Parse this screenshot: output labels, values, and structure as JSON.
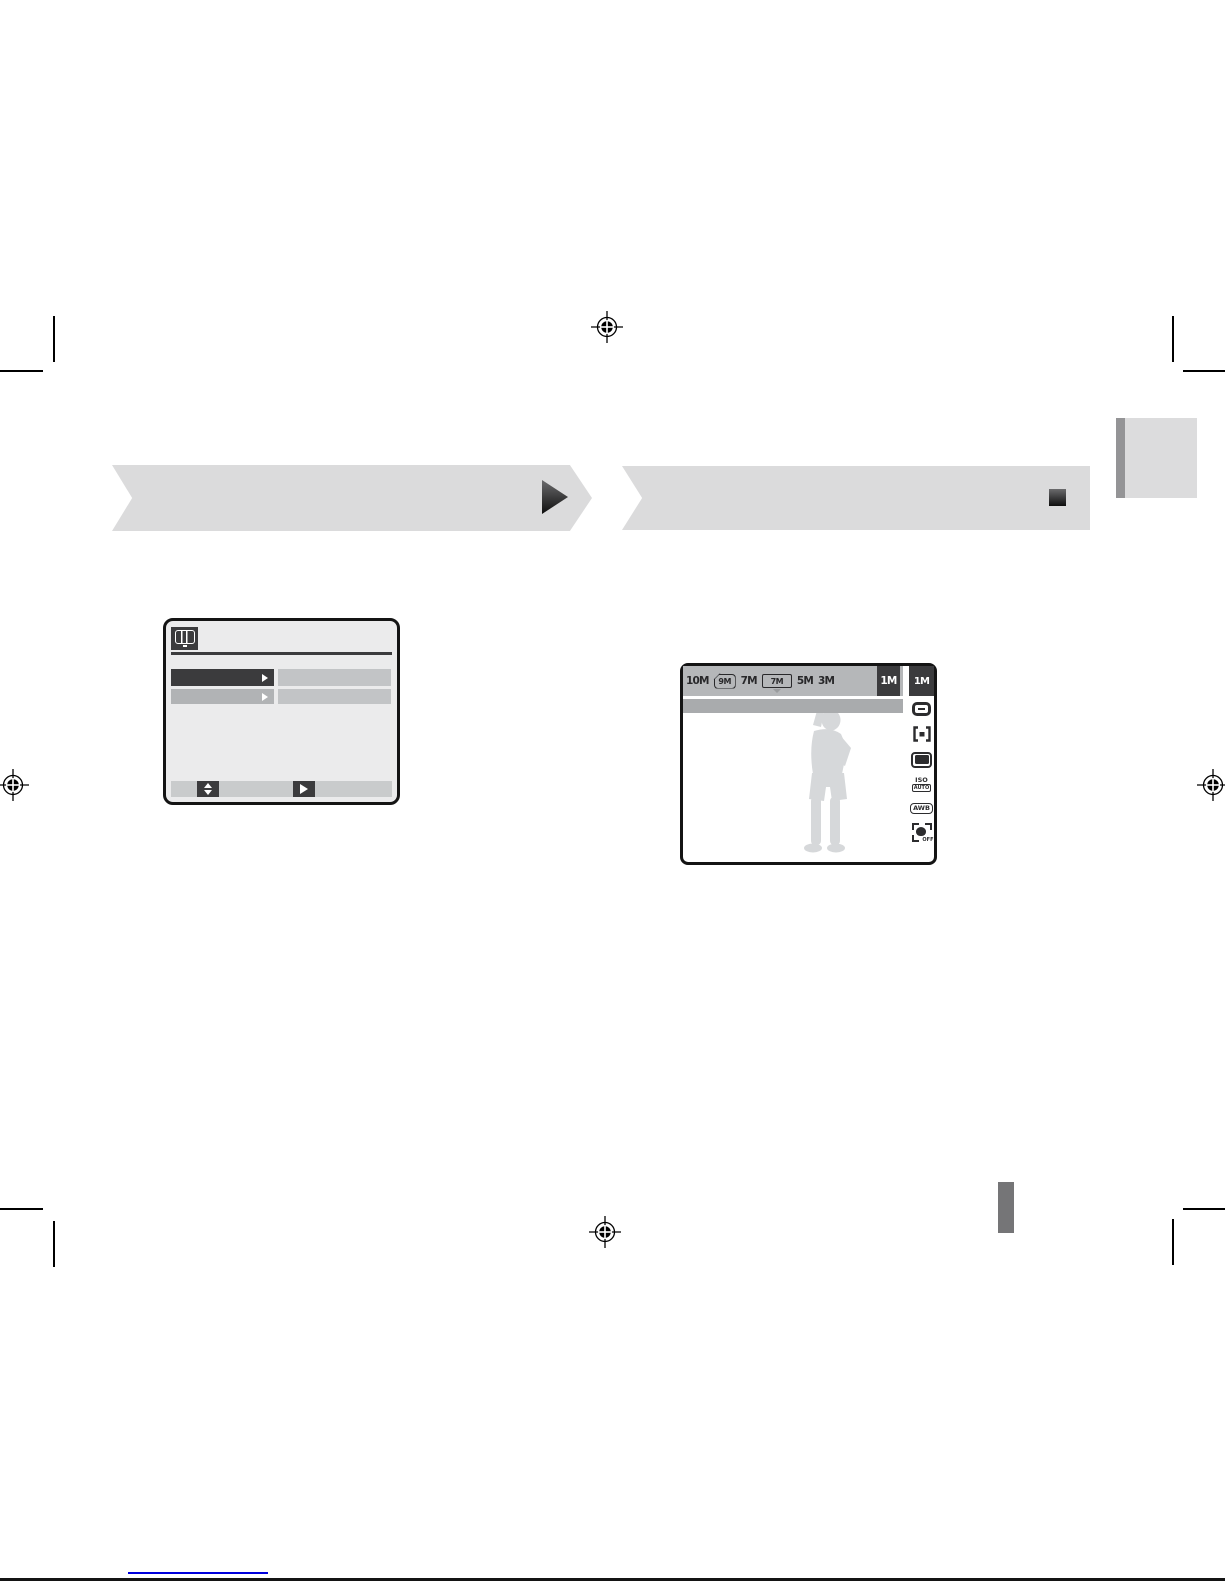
{
  "colors": {
    "banner_gray": "#dbdbdc",
    "ui_dark": "#3b3b3d",
    "lcd_bar_gray": "#b5b7b9",
    "info_bar_gray": "#a9abad",
    "silhouette_gray": "#d6d8da",
    "chapter_tab_gray": "#dcdcdd",
    "link_blue": "#0000dd"
  },
  "banners": {
    "left": {
      "label": "",
      "glyph": "forward-triangle"
    },
    "right": {
      "label": "",
      "glyph": "stop-square"
    }
  },
  "menu_screen": {
    "header_icon": "camera-lcd-icon",
    "rows": [
      {
        "label": "",
        "value": "",
        "selected": true
      },
      {
        "label": "",
        "value": "",
        "selected": false
      }
    ],
    "footer": {
      "nav_icon": "up-down-arrows",
      "set_icon": "right-arrow"
    }
  },
  "lcd_screen": {
    "resolutions": [
      {
        "label": "10M"
      },
      {
        "label": "9M",
        "frame": "photo"
      },
      {
        "label": "7M"
      },
      {
        "label": "7M",
        "frame": "wide"
      },
      {
        "label": "5M"
      },
      {
        "label": "3M"
      },
      {
        "label": "1M",
        "selected": true
      }
    ],
    "sidebar": {
      "current": "1M",
      "iso_label": "ISO",
      "iso_value": "AUTO",
      "white_balance": "AWB",
      "face_detection": "OFF"
    }
  }
}
